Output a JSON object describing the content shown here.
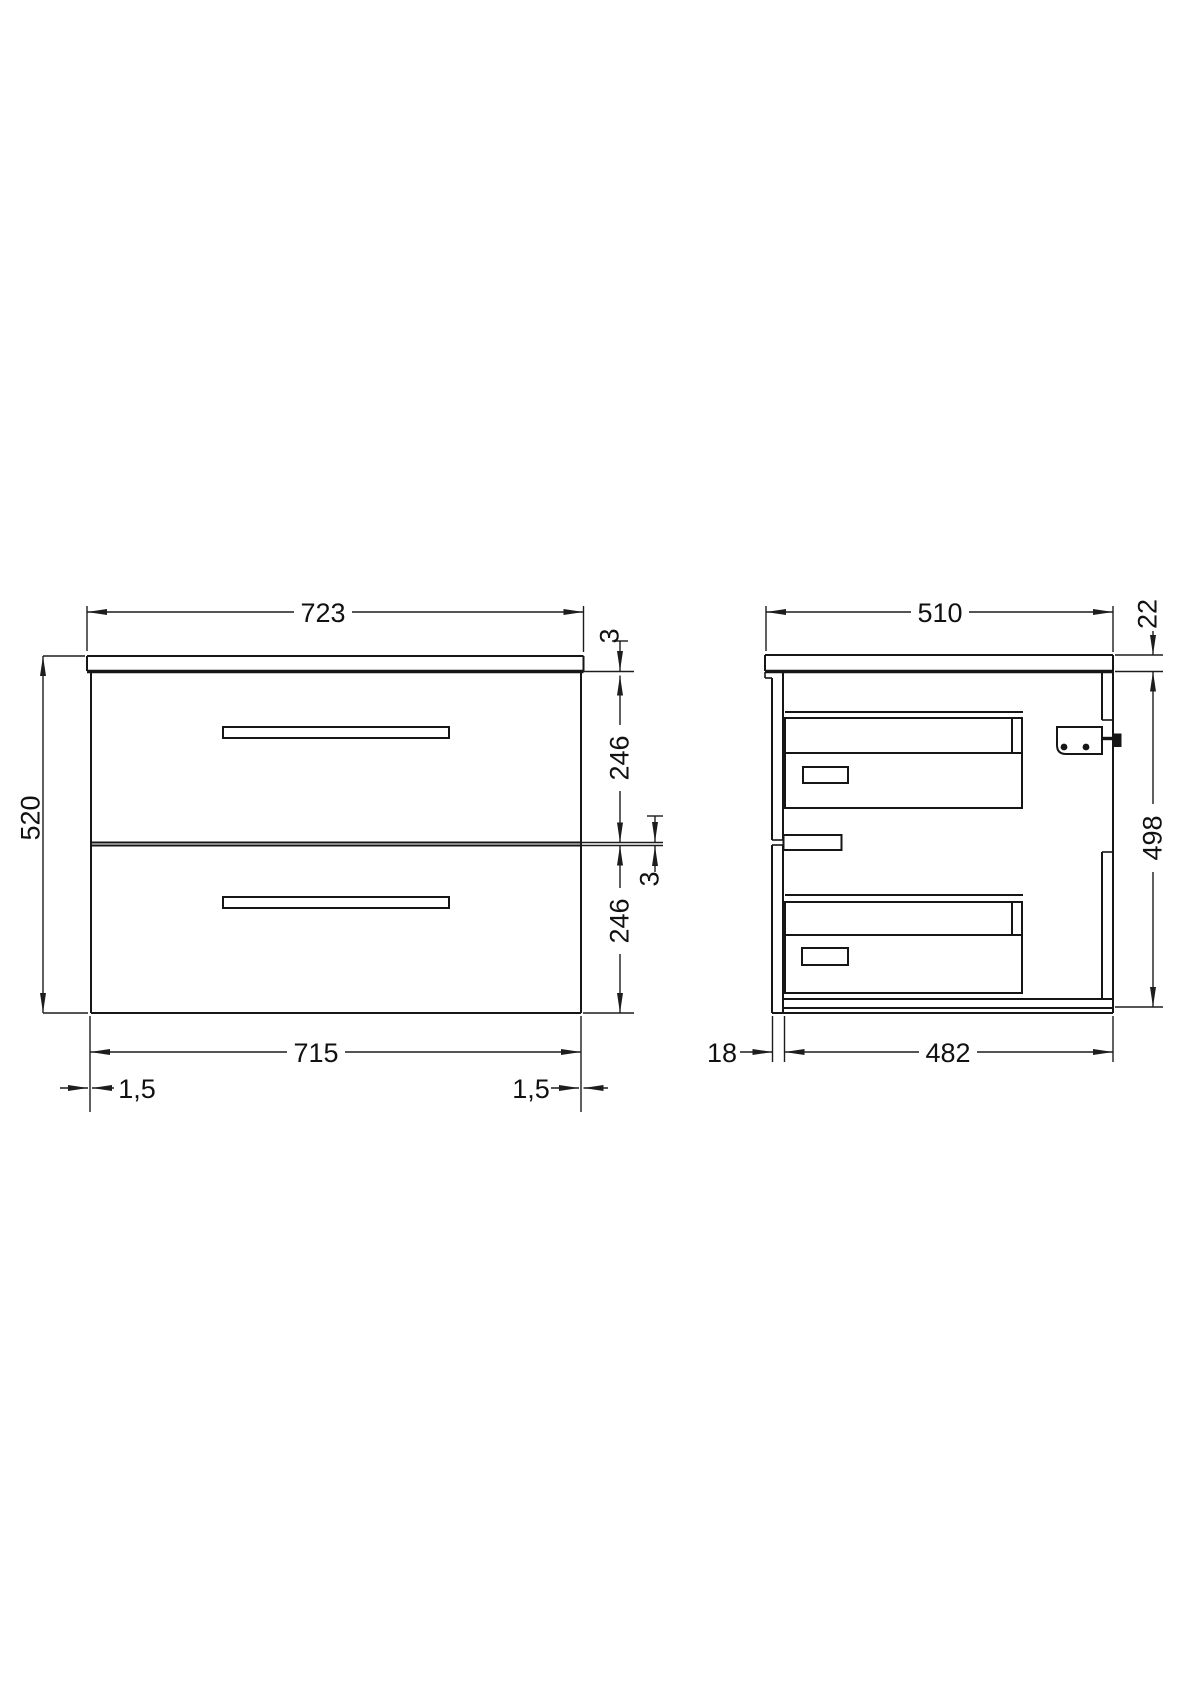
{
  "drawing": {
    "description": "Two-drawer wall-hung vanity unit technical drawing, front view and side view with millimetre dimensions",
    "front_view": {
      "overall_width": "723",
      "overall_height": "520",
      "top_gap": "3",
      "top_drawer_front_height": "246",
      "mid_gap": "3",
      "bottom_drawer_front_height": "246",
      "drawer_fronts_width": "715",
      "side_gap_left": "1,5",
      "side_gap_right": "1,5"
    },
    "side_view": {
      "overall_depth": "510",
      "worktop_thickness": "22",
      "cabinet_height": "498",
      "front_panel_thickness": "18",
      "cabinet_depth": "482"
    },
    "colors": {
      "line": "#161616",
      "background": "#ffffff",
      "text": "#111111"
    }
  }
}
